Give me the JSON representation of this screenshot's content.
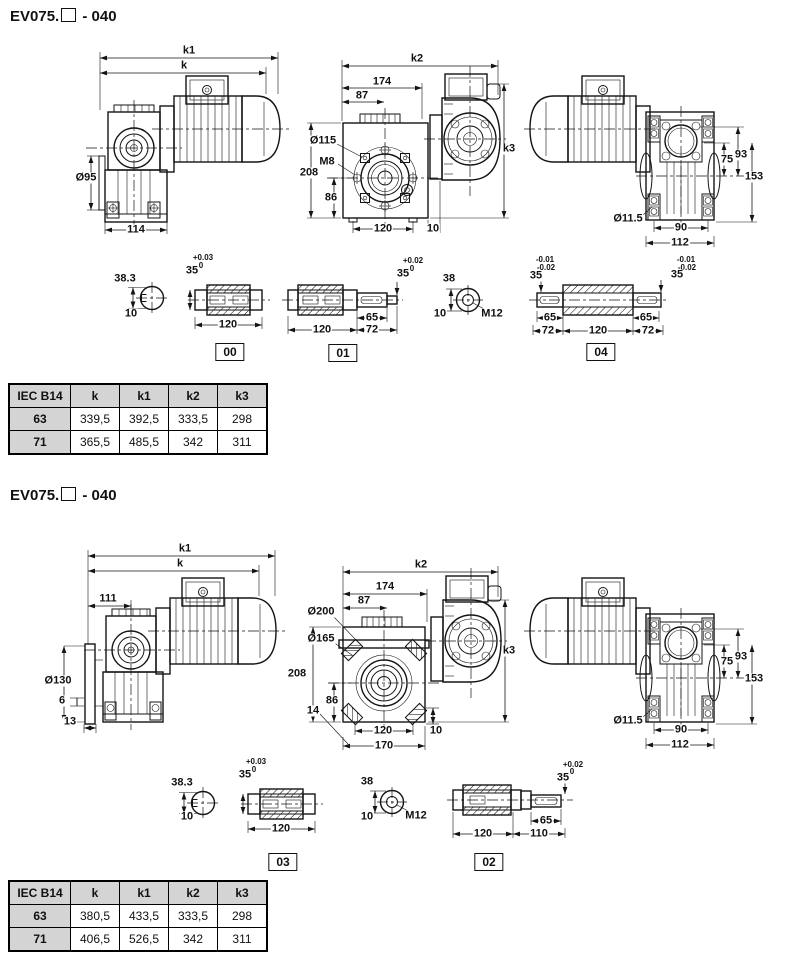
{
  "page": {
    "background": "#ffffff",
    "line_color": "#141414",
    "table_header_bg": "#d4d4d4"
  },
  "sections": [
    {
      "title_prefix": "EV075.",
      "title_suffix": " - 040",
      "table": {
        "headers": [
          "IEC B14",
          "k",
          "k1",
          "k2",
          "k3"
        ],
        "rows": [
          [
            "63",
            "339,5",
            "392,5",
            "333,5",
            "298"
          ],
          [
            "71",
            "365,5",
            "485,5",
            "342",
            "311"
          ]
        ]
      },
      "labels": [
        {
          "t": "k1",
          "x": 189,
          "y": 51
        },
        {
          "t": "k",
          "x": 184,
          "y": 66
        },
        {
          "t": "Ø95",
          "x": 86,
          "y": 178
        },
        {
          "t": "114",
          "x": 136,
          "y": 230
        },
        {
          "t": "k2",
          "x": 417,
          "y": 59
        },
        {
          "t": "174",
          "x": 382,
          "y": 82
        },
        {
          "t": "87",
          "x": 362,
          "y": 96
        },
        {
          "t": "Ø115",
          "x": 323,
          "y": 141
        },
        {
          "t": "M8",
          "x": 327,
          "y": 162
        },
        {
          "t": "208",
          "x": 309,
          "y": 173
        },
        {
          "t": "86",
          "x": 331,
          "y": 198
        },
        {
          "t": "120",
          "x": 383,
          "y": 229
        },
        {
          "t": "10",
          "x": 433,
          "y": 229
        },
        {
          "t": "k3",
          "x": 509,
          "y": 149
        },
        {
          "t": "75",
          "x": 727,
          "y": 160
        },
        {
          "t": "93",
          "x": 741,
          "y": 155
        },
        {
          "t": "153",
          "x": 754,
          "y": 177
        },
        {
          "t": "Ø11.5",
          "x": 628,
          "y": 219
        },
        {
          "t": "90",
          "x": 681,
          "y": 228
        },
        {
          "t": "112",
          "x": 680,
          "y": 243
        },
        {
          "t": "38.3",
          "x": 125,
          "y": 279
        },
        {
          "t": "10",
          "x": 131,
          "y": 314
        },
        {
          "t": "+0.03",
          "x": 203,
          "y": 258,
          "cls": "sm"
        },
        {
          "t": "35",
          "x": 192,
          "y": 271
        },
        {
          "t": "0",
          "x": 201,
          "y": 266,
          "cls": "sm"
        },
        {
          "t": "120",
          "x": 228,
          "y": 325
        },
        {
          "t": "00",
          "x": 230,
          "y": 352,
          "cls": "box"
        },
        {
          "t": "120",
          "x": 322,
          "y": 330
        },
        {
          "t": "65",
          "x": 372,
          "y": 318
        },
        {
          "t": "72",
          "x": 372,
          "y": 330
        },
        {
          "t": "+0.02",
          "x": 413,
          "y": 261,
          "cls": "sm"
        },
        {
          "t": "35",
          "x": 403,
          "y": 274
        },
        {
          "t": "0",
          "x": 412,
          "y": 269,
          "cls": "sm"
        },
        {
          "t": "01",
          "x": 343,
          "y": 353,
          "cls": "box"
        },
        {
          "t": "38",
          "x": 449,
          "y": 279
        },
        {
          "t": "10",
          "x": 440,
          "y": 314
        },
        {
          "t": "M12",
          "x": 492,
          "y": 314
        },
        {
          "t": "-0.01",
          "x": 545,
          "y": 260,
          "cls": "sm"
        },
        {
          "t": "-0.02",
          "x": 546,
          "y": 268,
          "cls": "sm"
        },
        {
          "t": "35",
          "x": 536,
          "y": 276
        },
        {
          "t": "65",
          "x": 550,
          "y": 318
        },
        {
          "t": "72",
          "x": 548,
          "y": 331
        },
        {
          "t": "120",
          "x": 598,
          "y": 331
        },
        {
          "t": "65",
          "x": 646,
          "y": 318
        },
        {
          "t": "72",
          "x": 648,
          "y": 331
        },
        {
          "t": "-0.01",
          "x": 686,
          "y": 260,
          "cls": "sm"
        },
        {
          "t": "-0.02",
          "x": 687,
          "y": 268,
          "cls": "sm"
        },
        {
          "t": "35",
          "x": 677,
          "y": 275
        },
        {
          "t": "04",
          "x": 601,
          "y": 352,
          "cls": "box"
        }
      ]
    },
    {
      "title_prefix": "EV075.",
      "title_suffix": " - 040",
      "table": {
        "headers": [
          "IEC B14",
          "k",
          "k1",
          "k2",
          "k3"
        ],
        "rows": [
          [
            "63",
            "380,5",
            "433,5",
            "333,5",
            "298"
          ],
          [
            "71",
            "406,5",
            "526,5",
            "342",
            "311"
          ]
        ]
      },
      "labels": [
        {
          "t": "k1",
          "x": 185,
          "y": 549
        },
        {
          "t": "k",
          "x": 180,
          "y": 564
        },
        {
          "t": "111",
          "x": 108,
          "y": 599
        },
        {
          "t": "Ø130",
          "x": 58,
          "y": 681
        },
        {
          "t": "6",
          "x": 62,
          "y": 701
        },
        {
          "t": "13",
          "x": 70,
          "y": 722
        },
        {
          "t": "k2",
          "x": 421,
          "y": 565
        },
        {
          "t": "174",
          "x": 385,
          "y": 587
        },
        {
          "t": "87",
          "x": 364,
          "y": 601
        },
        {
          "t": "Ø200",
          "x": 321,
          "y": 612
        },
        {
          "t": "Ø165",
          "x": 321,
          "y": 639
        },
        {
          "t": "208",
          "x": 297,
          "y": 674
        },
        {
          "t": "86",
          "x": 332,
          "y": 701
        },
        {
          "t": "14",
          "x": 313,
          "y": 711
        },
        {
          "t": "120",
          "x": 383,
          "y": 731
        },
        {
          "t": "10",
          "x": 436,
          "y": 731
        },
        {
          "t": "170",
          "x": 384,
          "y": 746
        },
        {
          "t": "k3",
          "x": 509,
          "y": 651
        },
        {
          "t": "75",
          "x": 727,
          "y": 662
        },
        {
          "t": "93",
          "x": 741,
          "y": 657
        },
        {
          "t": "153",
          "x": 754,
          "y": 679
        },
        {
          "t": "Ø11.5",
          "x": 628,
          "y": 721
        },
        {
          "t": "90",
          "x": 681,
          "y": 730
        },
        {
          "t": "112",
          "x": 680,
          "y": 745
        },
        {
          "t": "38.3",
          "x": 182,
          "y": 783
        },
        {
          "t": "10",
          "x": 187,
          "y": 817
        },
        {
          "t": "+0.03",
          "x": 256,
          "y": 762,
          "cls": "sm"
        },
        {
          "t": "35",
          "x": 245,
          "y": 775
        },
        {
          "t": "0",
          "x": 254,
          "y": 770,
          "cls": "sm"
        },
        {
          "t": "120",
          "x": 281,
          "y": 829
        },
        {
          "t": "03",
          "x": 283,
          "y": 862,
          "cls": "box"
        },
        {
          "t": "38",
          "x": 367,
          "y": 782
        },
        {
          "t": "10",
          "x": 367,
          "y": 817
        },
        {
          "t": "M12",
          "x": 416,
          "y": 816
        },
        {
          "t": "+0.02",
          "x": 573,
          "y": 765,
          "cls": "sm"
        },
        {
          "t": "35",
          "x": 563,
          "y": 778
        },
        {
          "t": "0",
          "x": 572,
          "y": 772,
          "cls": "sm"
        },
        {
          "t": "65",
          "x": 546,
          "y": 821
        },
        {
          "t": "120",
          "x": 483,
          "y": 834
        },
        {
          "t": "110",
          "x": 539,
          "y": 834
        },
        {
          "t": "02",
          "x": 489,
          "y": 862,
          "cls": "box"
        }
      ]
    }
  ]
}
